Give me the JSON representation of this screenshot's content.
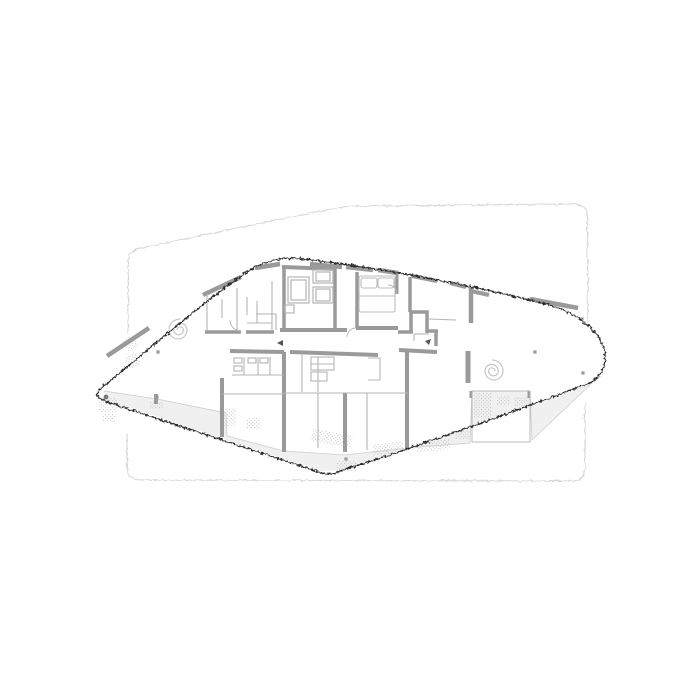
{
  "figure": {
    "kind": "architectural-floor-plan",
    "view": "upper-level-plan-with-ghosted-adjacent-floors"
  },
  "inventory": {
    "spiral_stairs": 2,
    "elevators": 2,
    "columns": 6,
    "ghost_floor_outlines": 2,
    "beds": 1
  },
  "colors": {
    "background": "#ffffff",
    "plan_fill": "#ffffff",
    "outline": "#2b2b2b",
    "inner_line": "#d6d6d6",
    "ghost": "#d7d7d7",
    "ghost_light": "#e2e2e2",
    "wall": "#9a9a9a",
    "partition": "#b4b4b4",
    "furniture": "#bcbcbc",
    "spiral": "#c8c8c8",
    "terrace_fill": "#f0f0f0",
    "terrace_edge": "#cccccc",
    "stipple": "#c0c0c0",
    "column": "#999999",
    "column_dark": "#787878",
    "marker": "#555555"
  }
}
